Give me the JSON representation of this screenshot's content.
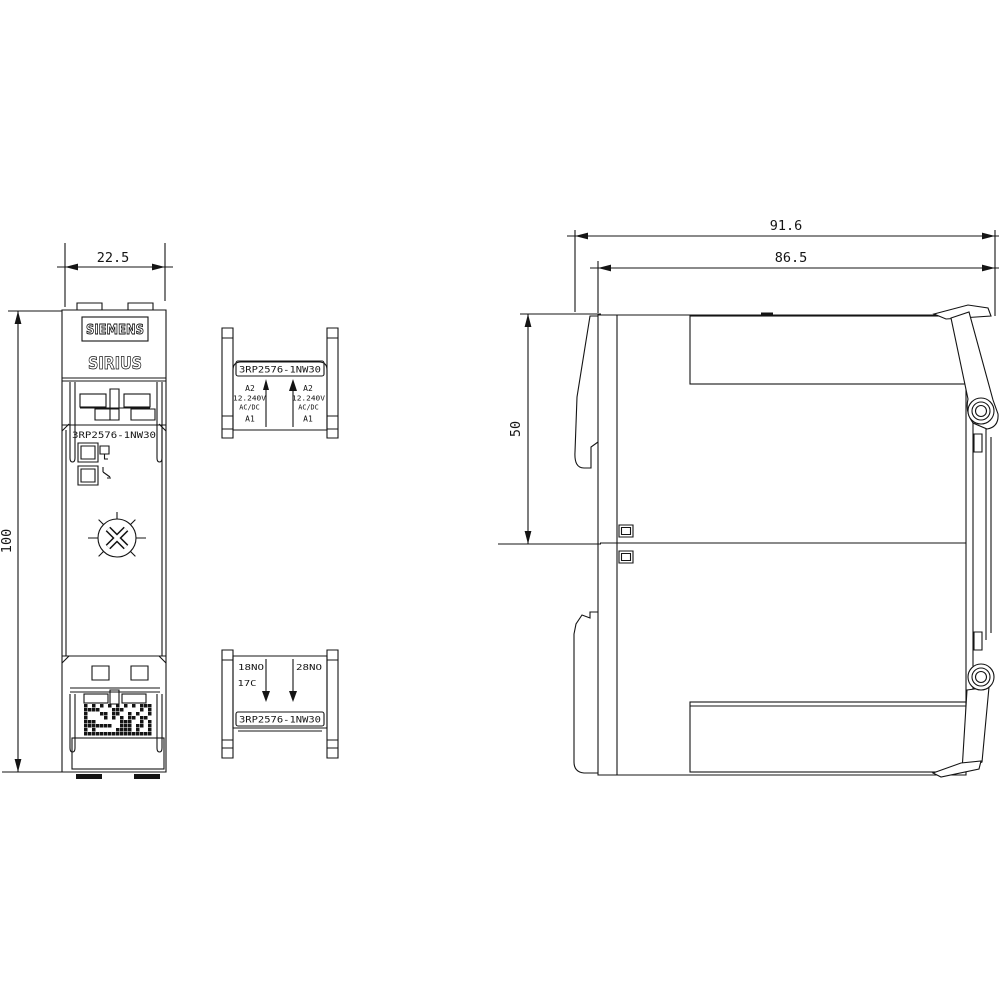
{
  "product": {
    "brand": "SIEMENS",
    "series": "SIRIUS",
    "code": "3RP2576-1NW30"
  },
  "dimensions_mm": {
    "width": "22.5",
    "height": "100",
    "depth_total": "91.6",
    "depth_body": "86.5",
    "upper_section_height": "50"
  },
  "coil_terminal_block": {
    "code": "3RP2576-1NW30",
    "left": {
      "a2": "A2",
      "voltage": "12.240V",
      "supply": "AC/DC",
      "a1": "A1"
    },
    "right": {
      "a2": "A2",
      "voltage": "12.240V",
      "supply": "AC/DC",
      "a1": "A1"
    }
  },
  "output_terminal_block": {
    "code": "3RP2576-1NW30",
    "contact_18": "18NO",
    "contact_17": "17C",
    "contact_28": "28NO"
  }
}
